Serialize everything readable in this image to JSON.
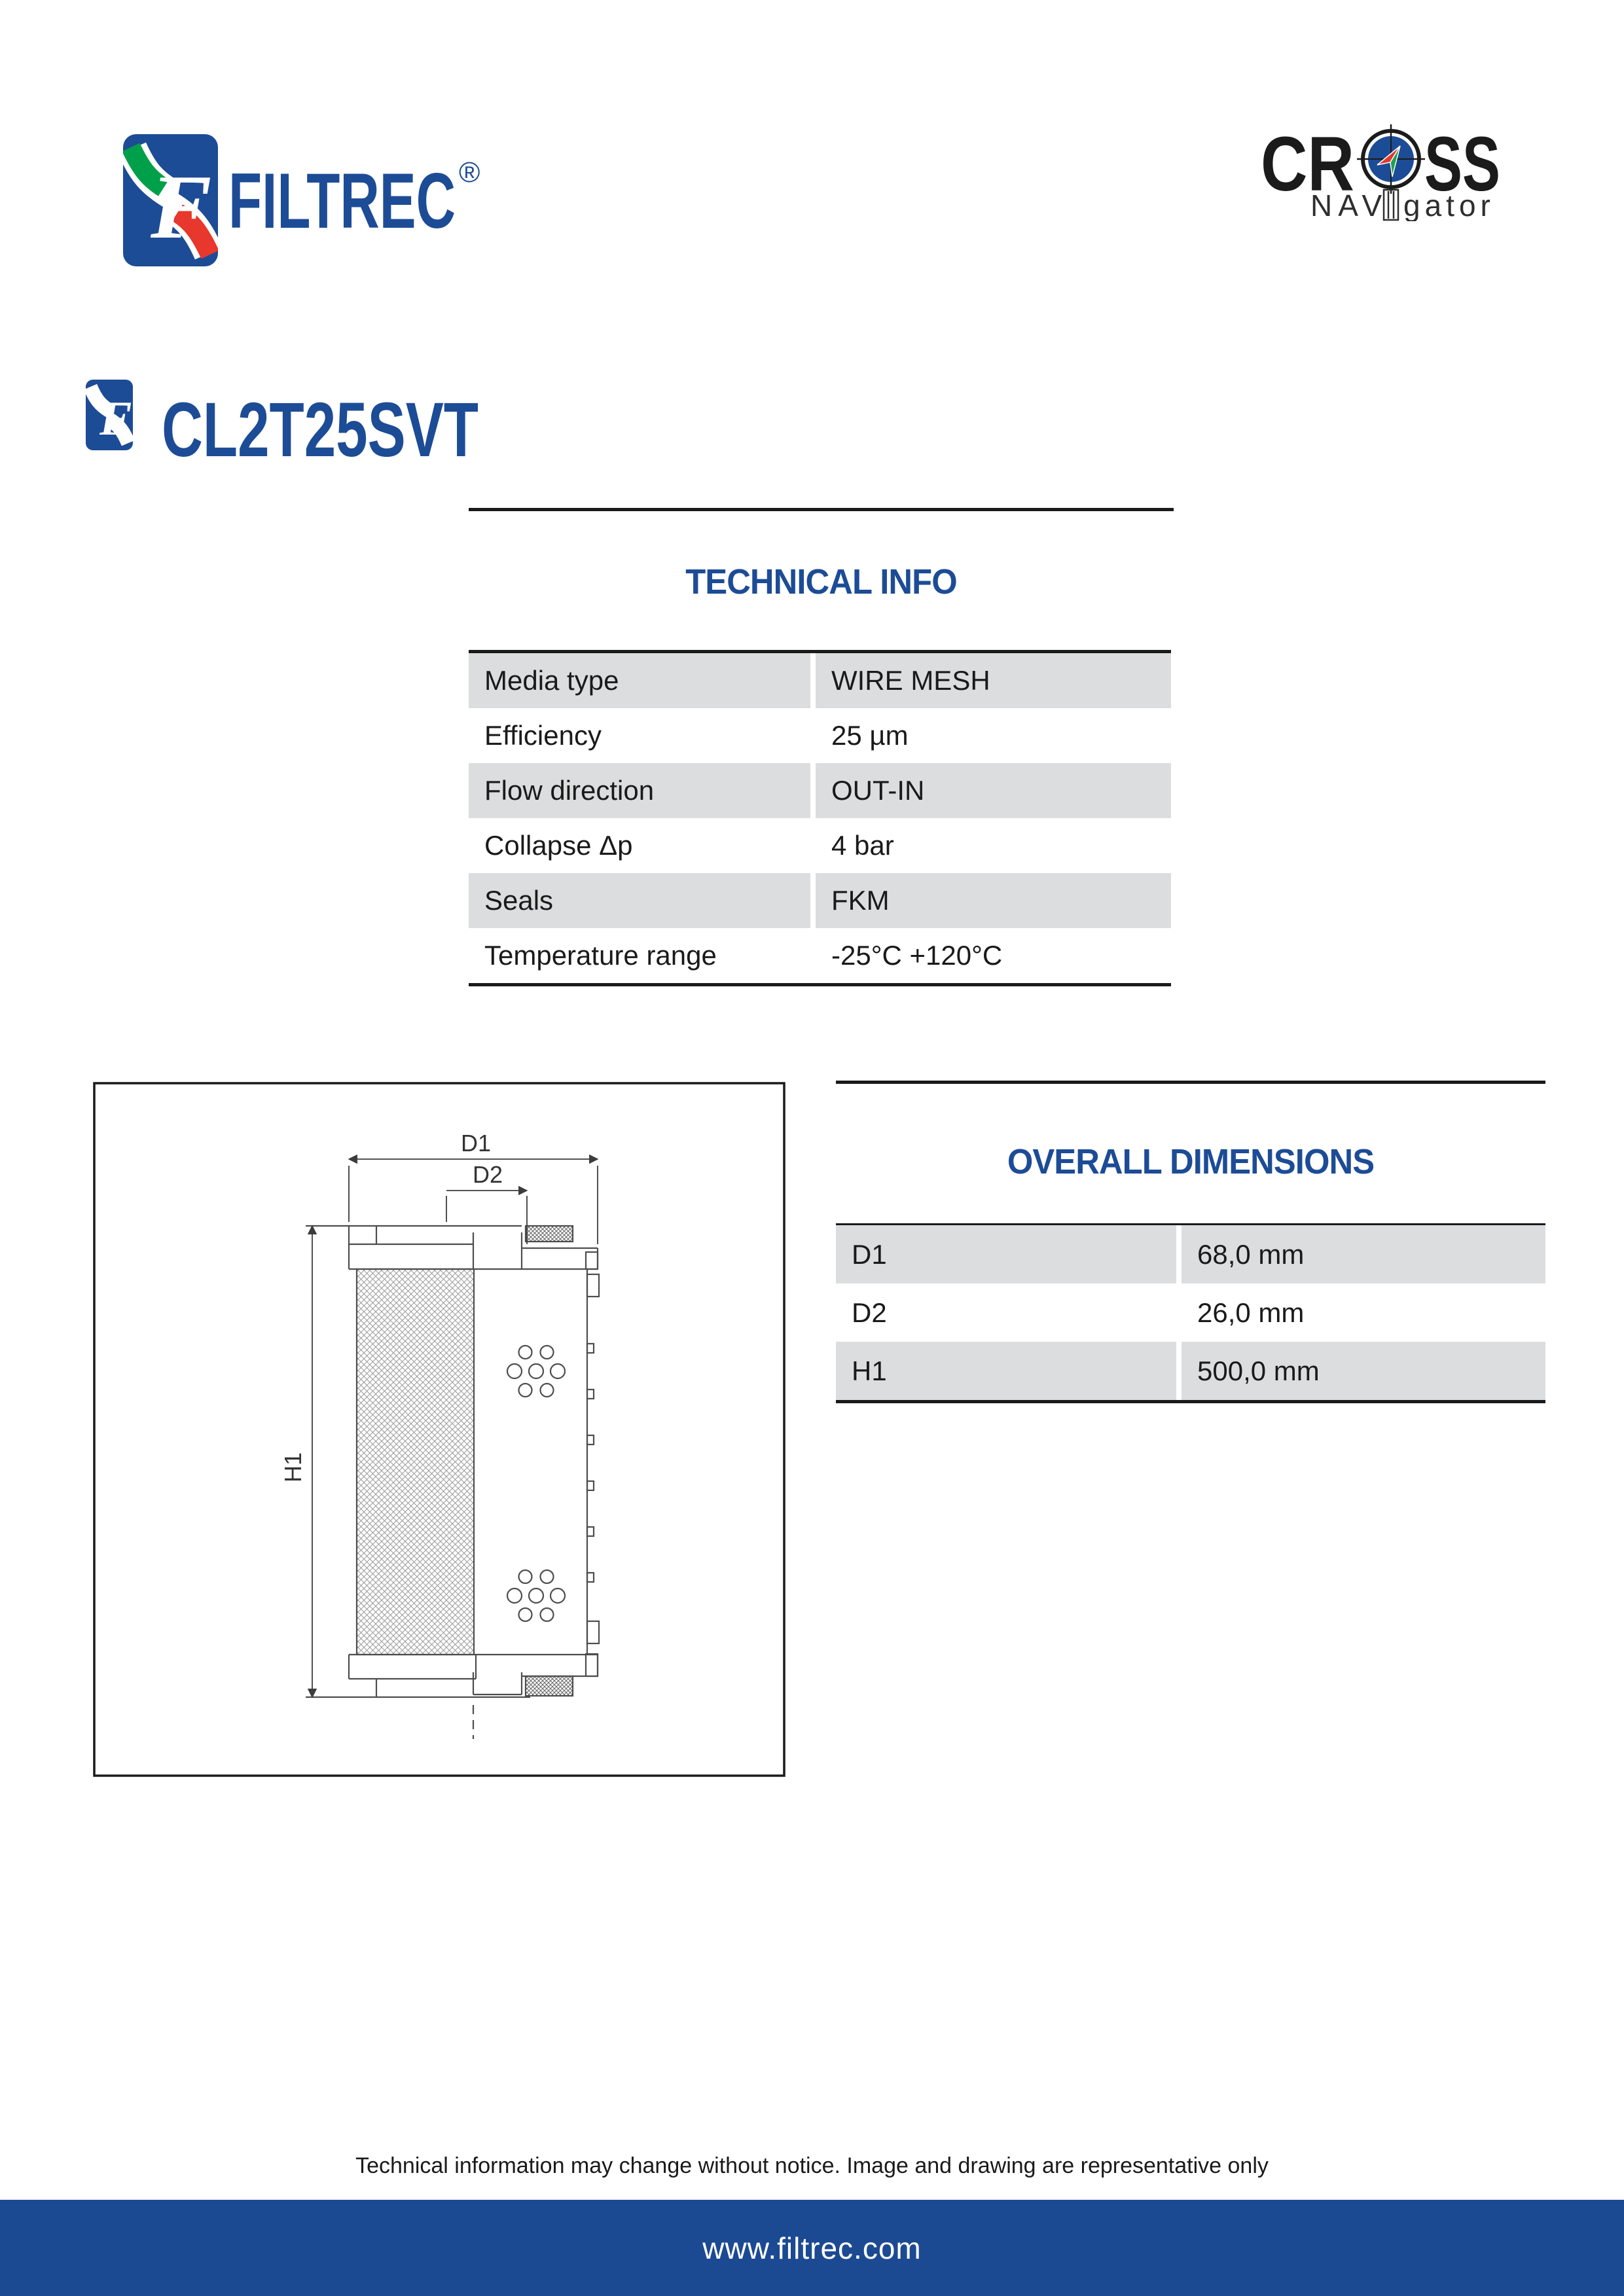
{
  "header": {
    "filtrec": {
      "brand": "FILTREC",
      "registered": "®",
      "logo_icon": "filtrec-f-logo"
    },
    "cross_navigator": {
      "word_left": "CR",
      "word_right": "SS",
      "sub_left": "NAV",
      "sub_right": "gator",
      "compass_icon": "compass-icon",
      "column_icon": "column-icon"
    }
  },
  "product": {
    "code": "CL2T25SVT",
    "icon": "filtrec-f-mini-logo"
  },
  "technical_info": {
    "title": "TECHNICAL INFO",
    "rows": [
      {
        "label": "Media type",
        "value": "WIRE MESH"
      },
      {
        "label": "Efficiency",
        "value": "25 µm"
      },
      {
        "label": "Flow direction",
        "value": "OUT-IN"
      },
      {
        "label": "Collapse Δp",
        "value": "4 bar"
      },
      {
        "label": "Seals",
        "value": "FKM"
      },
      {
        "label": "Temperature range",
        "value": "-25°C +120°C"
      }
    ]
  },
  "overall_dimensions": {
    "title": "OVERALL DIMENSIONS",
    "rows": [
      {
        "label": "D1",
        "value": "68,0 mm"
      },
      {
        "label": "D2",
        "value": "26,0 mm"
      },
      {
        "label": "H1",
        "value": "500,0 mm"
      }
    ]
  },
  "drawing": {
    "dim_labels": {
      "d1": "D1",
      "d2": "D2",
      "h1": "H1"
    }
  },
  "footer": {
    "disclaimer": "Technical information may change without notice. Image and drawing are representative only",
    "website": "www.filtrec.com"
  },
  "colors": {
    "brand_blue": "#1d4c96",
    "row_gray": "#dcddde",
    "footer_blue": "#1c4a92",
    "logo_green": "#00a04a",
    "logo_red": "#e8372c",
    "text_black": "#1a1a1a"
  }
}
